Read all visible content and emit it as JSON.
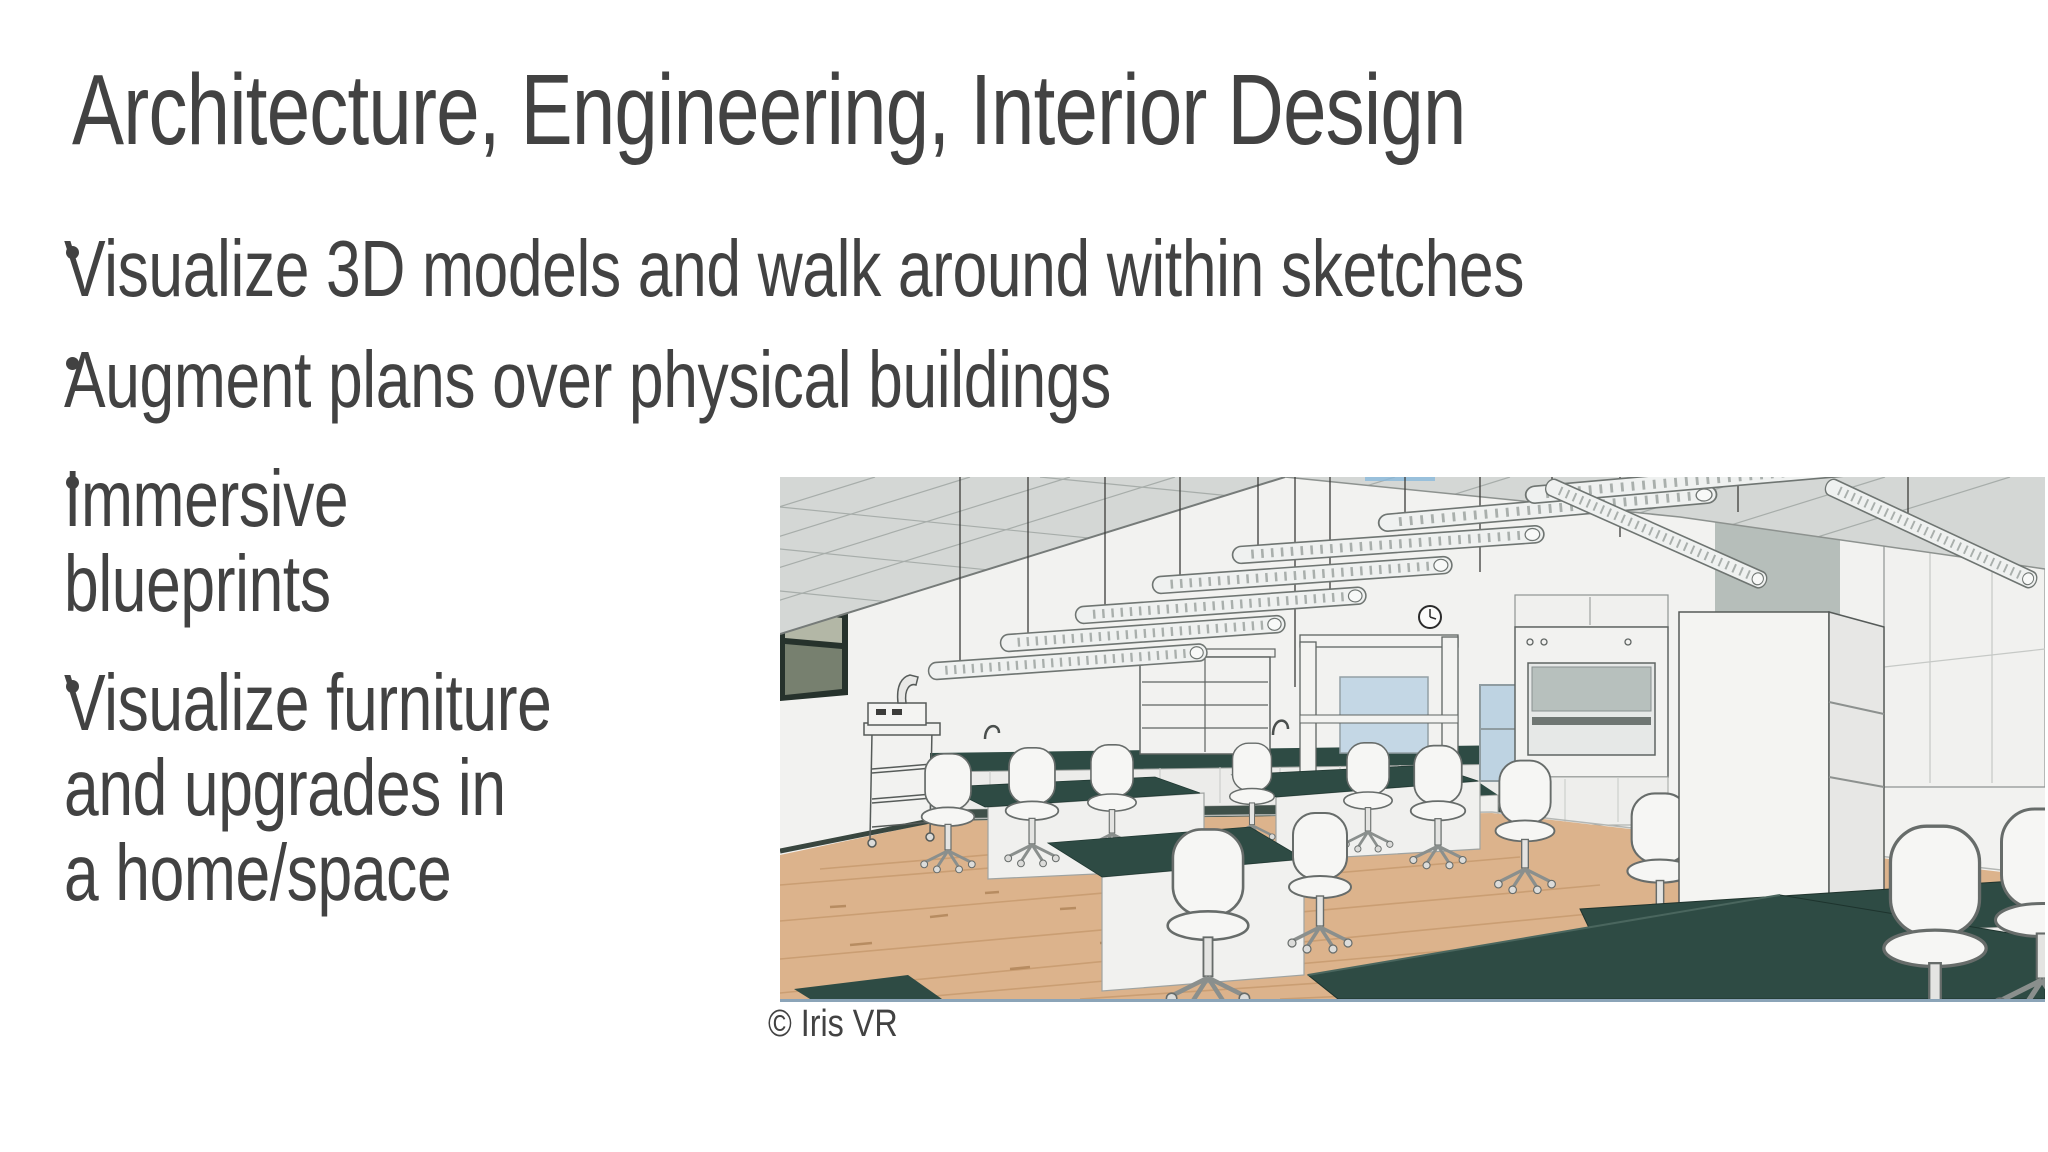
{
  "slide": {
    "title": "Architecture, Engineering, Interior Design"
  },
  "bullets": [
    {
      "lines": [
        "Visualize 3D models and walk around within sketches"
      ]
    },
    {
      "lines": [
        "Augment plans over physical buildings"
      ]
    },
    {
      "lines": [
        "Immersive",
        "blueprints"
      ]
    },
    {
      "lines": [
        "Visualize furniture",
        "and upgrades in",
        "a home/space"
      ]
    }
  ],
  "image": {
    "credit": "© Iris VR",
    "description": "3D architectural rendering of a science lab classroom with dark-top benches, white swivel chairs, hanging tube lights, a fume hood and wood flooring"
  },
  "colors": {
    "text": "#424242",
    "countertop": "#2e4b44",
    "wood_floor": "#dcb38c",
    "ceiling": "#d4d7d5",
    "wall": "#f2f2f0",
    "chair": "#f6f6f4",
    "image_border": "#8ba4b8"
  }
}
